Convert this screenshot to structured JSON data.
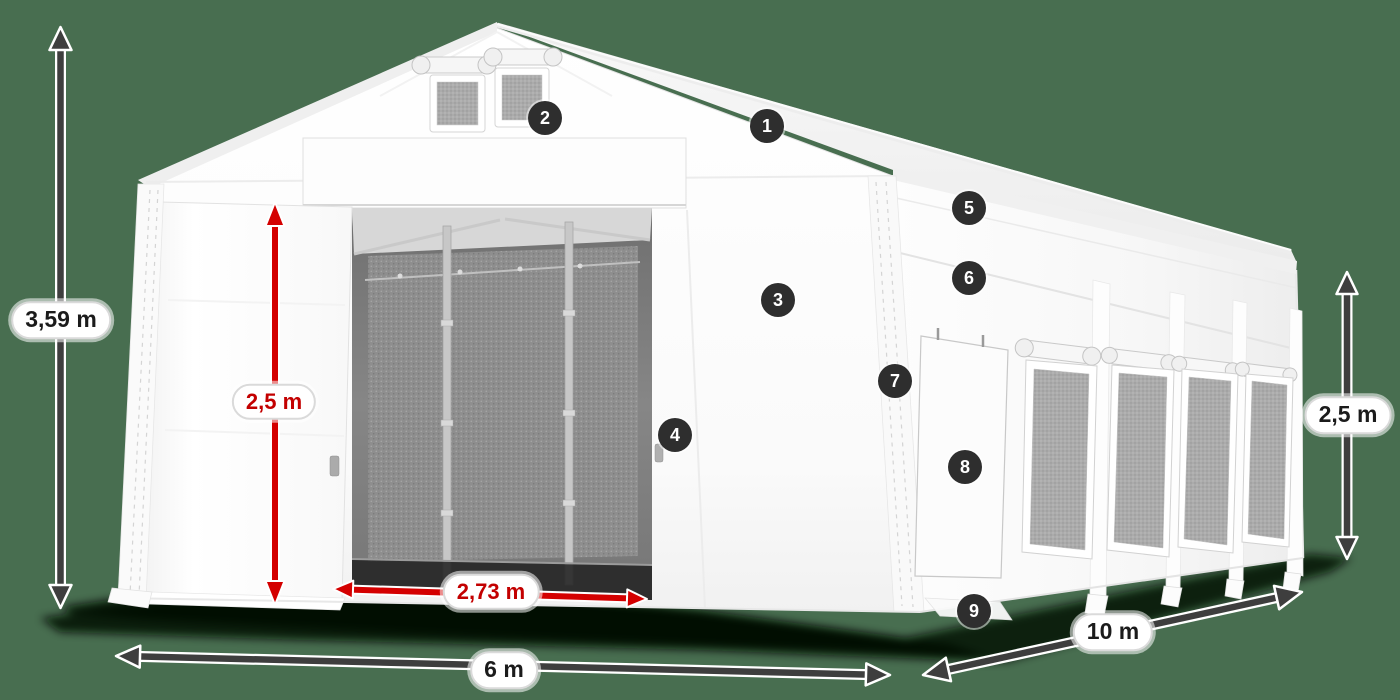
{
  "scene": {
    "description": "White PVC storage tent 6 x 10 m shown in perspective with numbered feature callouts and dimension arrows",
    "background_color": "#486E50"
  },
  "dimensions": [
    {
      "id": "total-height",
      "label": "3,59 m",
      "color": "dark"
    },
    {
      "id": "door-height",
      "label": "2,5 m",
      "color": "red"
    },
    {
      "id": "door-width",
      "label": "2,73 m",
      "color": "red"
    },
    {
      "id": "front-width",
      "label": "6 m",
      "color": "dark"
    },
    {
      "id": "side-length",
      "label": "10 m",
      "color": "dark"
    },
    {
      "id": "side-height",
      "label": "2,5 m",
      "color": "dark"
    }
  ],
  "callouts": [
    {
      "number": "1"
    },
    {
      "number": "2"
    },
    {
      "number": "3"
    },
    {
      "number": "4"
    },
    {
      "number": "5"
    },
    {
      "number": "6"
    },
    {
      "number": "7"
    },
    {
      "number": "8"
    },
    {
      "number": "9"
    }
  ],
  "colors": {
    "arrow_dark": "#3e3e3e",
    "arrow_red": "#d40000",
    "badge_background": "#2e2e2e",
    "pill_text": "#1b1b1b",
    "pill_red_text": "#c30000",
    "tent_white": "#ffffff",
    "background": "#486E50"
  }
}
